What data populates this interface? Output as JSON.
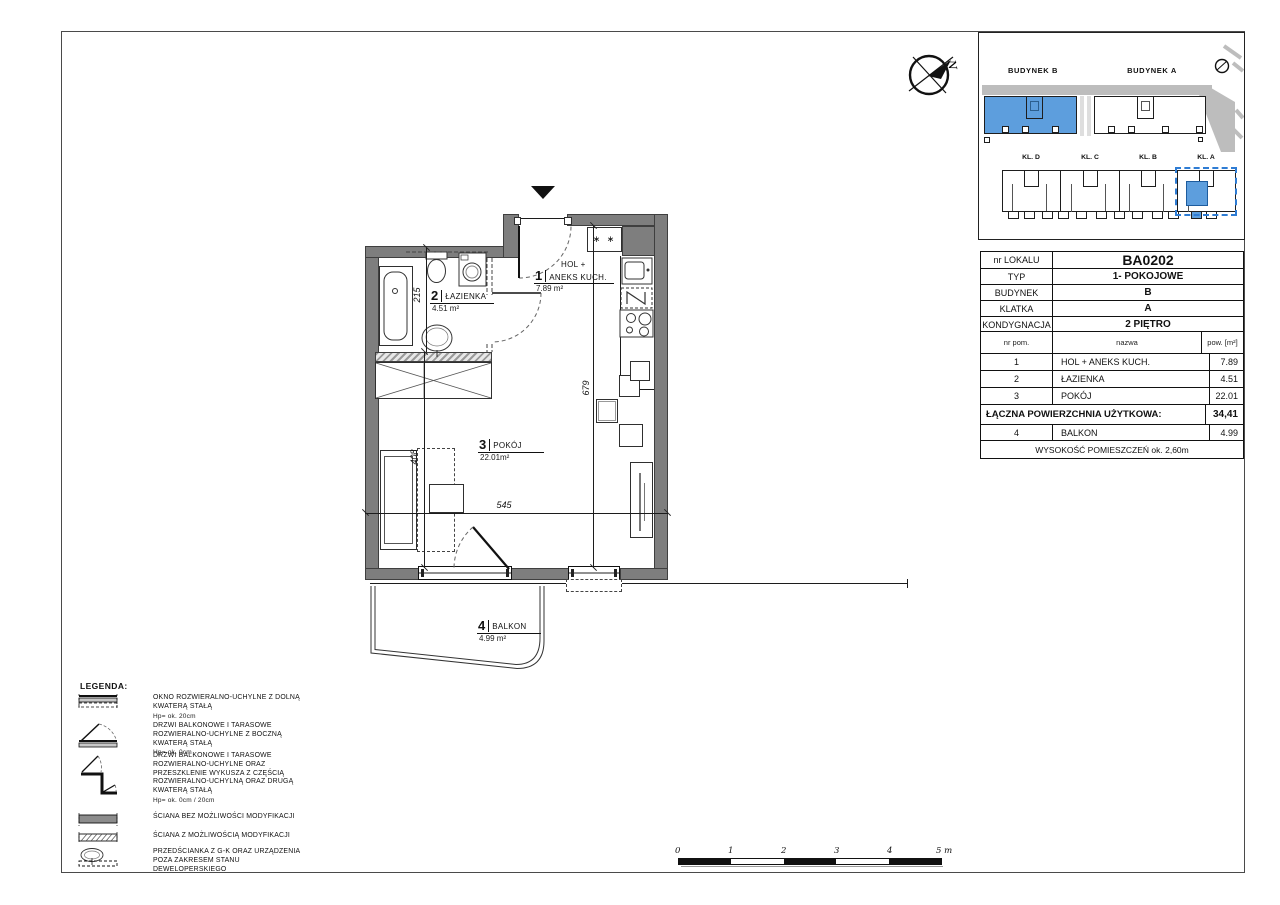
{
  "compass": {
    "north_label": "N"
  },
  "site_plan": {
    "building_b_label": "BUDYNEK B",
    "building_a_label": "BUDYNEK A",
    "stair_labels": [
      "KL. D",
      "KL. C",
      "KL. B",
      "KL. A"
    ],
    "accent_color": "#5d9edd"
  },
  "unit_info": {
    "rows": [
      {
        "label": "nr LOKALU",
        "value": "BA0202"
      },
      {
        "label": "TYP",
        "value": "1- POKOJOWE"
      },
      {
        "label": "BUDYNEK",
        "value": "B"
      },
      {
        "label": "KLATKA",
        "value": "A"
      },
      {
        "label": "KONDYGNACJA",
        "value": "2 PIĘTRO"
      }
    ]
  },
  "room_table": {
    "headers": [
      "nr pom.",
      "nazwa",
      "pow. [m²]"
    ],
    "rows": [
      {
        "num": "1",
        "name": "HOL + ANEKS KUCH.",
        "area": "7.89"
      },
      {
        "num": "2",
        "name": "ŁAZIENKA",
        "area": "4.51"
      },
      {
        "num": "3",
        "name": "POKÓJ",
        "area": "22.01"
      }
    ],
    "total_label": "ŁĄCZNA POWIERZCHNIA UŻYTKOWA:",
    "total_value": "34,41",
    "balcony_row": {
      "num": "4",
      "name": "BALKON",
      "area": "4.99"
    },
    "footer": "WYSOKOŚĆ POMIESZCZEŃ ok. 2,60m"
  },
  "floor_plan": {
    "rooms": [
      {
        "num": "1",
        "pre": "HOL +",
        "name": "ANEKS KUCH.",
        "area": "7.89 m²"
      },
      {
        "num": "2",
        "name": "ŁAZIENKA",
        "area": "4.51 m²"
      },
      {
        "num": "3",
        "name": "POKÓJ",
        "area": "22.01m²"
      },
      {
        "num": "4",
        "name": "BALKON",
        "area": "4.99 m²"
      }
    ],
    "dimensions": {
      "bathroom": "215",
      "room": "408",
      "width": "545",
      "depth": "679"
    },
    "kitchen": {
      "cabinet_symbol": "∗ ∗",
      "fridge_symbol": "N"
    }
  },
  "legend": {
    "title": "LEGENDA:",
    "items": [
      {
        "text": "OKNO ROZWIERALNO-UCHYLNE Z DOLNĄ KWATERĄ STAŁĄ",
        "note": "Hp= ok. 20cm"
      },
      {
        "text": "DRZWI BALKONOWE I TARASOWE ROZWIERALNO-UCHYLNE Z BOCZNĄ KWATERĄ STAŁĄ",
        "note": "Hp= ok. 0cm"
      },
      {
        "text": "DRZWI BALKONOWE I TARASOWE ROZWIERALNO-UCHYLNE ORAZ PRZESZKLENIE WYKUSZA Z CZĘŚCIĄ ROZWIERALNO-UCHYLNĄ ORAZ DRUGĄ KWATERĄ STAŁĄ",
        "note": "Hp= ok. 0cm / 20cm"
      },
      {
        "text": "ŚCIANA BEZ MOŻLIWOŚCI MODYFIKACJI",
        "note": ""
      },
      {
        "text": "ŚCIANA Z MOŻLIWOŚCIĄ MODYFIKACJI",
        "note": ""
      },
      {
        "text": "PRZEDŚCIANKA Z G-K ORAZ URZĄDZENIA POZA ZAKRESEM STANU DEWELOPERSKIEGO",
        "note": ""
      }
    ]
  },
  "scale_bar": {
    "ticks": [
      "0",
      "1",
      "2",
      "3",
      "4"
    ],
    "end_label": "5 m"
  }
}
